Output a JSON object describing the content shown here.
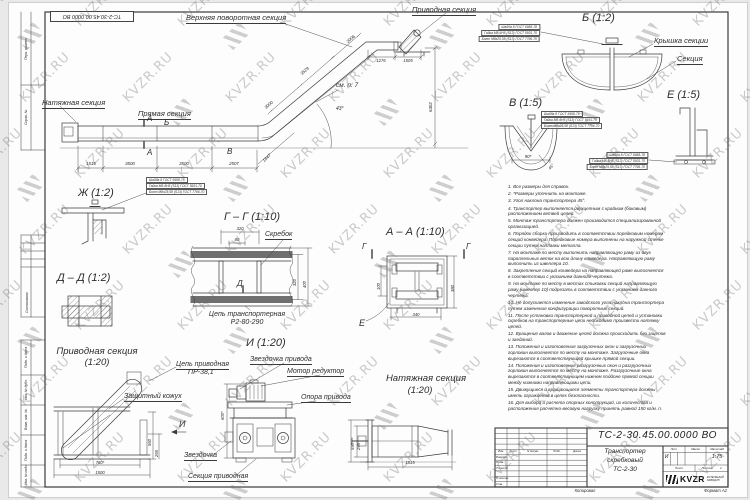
{
  "watermark": {
    "text": "KVZR.RU"
  },
  "stamp": {
    "text": "ТС-2-30.45.00.0000 ВО"
  },
  "labels": [
    {
      "n": "label-natyazhnaya-s",
      "t": "Натяжная секция",
      "x": 42,
      "y": 99,
      "fs": 7.5,
      "u": 1
    },
    {
      "n": "label-pryamaya-s",
      "t": "Прямая секция",
      "x": 138,
      "y": 110,
      "fs": 7.5,
      "u": 1
    },
    {
      "n": "label-verhnyaya-povorotnaya-s",
      "t": "Верхняя поворотная секция",
      "x": 186,
      "y": 14,
      "fs": 7.5,
      "u": 1
    },
    {
      "n": "label-privodnaya-s",
      "t": "Приводная секция",
      "x": 412,
      "y": 6,
      "fs": 7.5,
      "u": 1
    },
    {
      "n": "section-mark-a-top",
      "t": "А",
      "x": 147,
      "y": 115,
      "fs": 8
    },
    {
      "n": "section-mark-a-bottom",
      "t": "А",
      "x": 147,
      "y": 149,
      "fs": 8
    },
    {
      "n": "detail-mark-b",
      "t": "Б",
      "x": 164,
      "y": 119,
      "fs": 8
    },
    {
      "n": "detail-mark-v",
      "t": "В",
      "x": 227,
      "y": 148,
      "fs": 8
    },
    {
      "n": "dim-1515",
      "t": "1515",
      "x": 91,
      "y": 162,
      "fs": 4.4,
      "al": "c"
    },
    {
      "n": "dim-3500-1",
      "t": "3500",
      "x": 130,
      "y": 162,
      "fs": 4.4,
      "al": "c"
    },
    {
      "n": "dim-3500-2",
      "t": "3500",
      "x": 184,
      "y": 162,
      "fs": 4.4,
      "al": "c"
    },
    {
      "n": "dim-2507",
      "t": "2507",
      "x": 234,
      "y": 162,
      "fs": 4.4,
      "al": "c"
    },
    {
      "n": "dim-1847",
      "t": "1847",
      "x": 262,
      "y": 160,
      "fs": 4.4,
      "rot": -42
    },
    {
      "n": "dim-2006",
      "t": "2006",
      "x": 346,
      "y": 41,
      "fs": 4.4,
      "rot": -41
    },
    {
      "n": "dim-3529",
      "t": "3529",
      "x": 300,
      "y": 73,
      "fs": 4.4,
      "rot": -41
    },
    {
      "n": "dim-3000",
      "t": "3000",
      "x": 264,
      "y": 107,
      "fs": 4.4,
      "rot": -41
    },
    {
      "n": "note-see-item-7",
      "t": "см. п. 7",
      "x": 336,
      "y": 83,
      "fs": 6.5
    },
    {
      "n": "dim-angle-43",
      "t": "43°",
      "x": 336,
      "y": 107,
      "fs": 5
    },
    {
      "n": "dim-1276",
      "t": "1276",
      "x": 381,
      "y": 59,
      "fs": 4.2,
      "al": "c"
    },
    {
      "n": "dim-1505",
      "t": "1505",
      "x": 408,
      "y": 59,
      "fs": 4.2,
      "al": "c"
    },
    {
      "n": "dim-6302",
      "t": "6302",
      "x": 429,
      "y": 112,
      "fs": 4.4,
      "rot": -90
    },
    {
      "n": "callout-washer",
      "t": "Шайба 8 ГОСТ 6958-78",
      "x": 540,
      "y": 24,
      "fs": 3.3,
      "al": "r",
      "cls": "box"
    },
    {
      "n": "callout-nut",
      "t": "Гайка М8-6Н5 (S13) ГОСТ 5931-70",
      "x": 540,
      "y": 30,
      "fs": 3.3,
      "al": "r",
      "cls": "box"
    },
    {
      "n": "callout-bolt",
      "t": "Болт М8х25,58 (S13) ГОСТ 7796-70",
      "x": 540,
      "y": 36,
      "fs": 3.3,
      "al": "r",
      "cls": "box"
    },
    {
      "n": "detail-b-title",
      "t": "Б (1:2)",
      "x": 582,
      "y": 13,
      "fs": 11
    },
    {
      "n": "label-kryshka-sekcii",
      "t": "Крышка секции",
      "x": 654,
      "y": 37,
      "fs": 7.5,
      "u": 1
    },
    {
      "n": "label-sekciya",
      "t": "Секция",
      "x": 677,
      "y": 55,
      "fs": 7.5,
      "u": 1
    },
    {
      "n": "detail-v-title",
      "t": "В (1:5)",
      "x": 509,
      "y": 98,
      "fs": 11
    },
    {
      "n": "callout-washer-v",
      "t": "Шайба 8 ГОСТ 6958-78",
      "x": 541,
      "y": 111,
      "fs": 3.3,
      "cls": "box"
    },
    {
      "n": "callout-nut-v",
      "t": "Гайка М8-6Н5 (S13) ГОСТ 5931-70",
      "x": 541,
      "y": 117,
      "fs": 3.3,
      "cls": "box"
    },
    {
      "n": "callout-bolt-v",
      "t": "Болт М8х25,58 (S13) ГОСТ 7796-70",
      "x": 541,
      "y": 123,
      "fs": 3.3,
      "cls": "box"
    },
    {
      "n": "dim-90",
      "t": "90*",
      "x": 528,
      "y": 155,
      "fs": 4.4,
      "al": "c"
    },
    {
      "n": "dim-angle-45",
      "t": "45°",
      "x": 548,
      "y": 168,
      "fs": 4,
      "rot": -50
    },
    {
      "n": "detail-e-title",
      "t": "Е (1:5)",
      "x": 667,
      "y": 90,
      "fs": 11
    },
    {
      "n": "callout-washer-e",
      "t": "Шайба 8 ГОСТ 6958-78",
      "x": 648,
      "y": 152,
      "fs": 3.3,
      "al": "r",
      "cls": "box"
    },
    {
      "n": "callout-nut-e",
      "t": "Гайка М8-6Н5 (S13) ГОСТ 5931-70",
      "x": 648,
      "y": 158,
      "fs": 3.3,
      "al": "r",
      "cls": "box"
    },
    {
      "n": "callout-bolt-e",
      "t": "Болт М8х25,58 (S13) ГОСТ 7796-70",
      "x": 648,
      "y": 164,
      "fs": 3.3,
      "al": "r",
      "cls": "box"
    },
    {
      "n": "detail-zh-title",
      "t": "Ж (1:2)",
      "x": 78,
      "y": 188,
      "fs": 11
    },
    {
      "n": "callout-washer-zh",
      "t": "Шайба 8 ГОСТ 6958-78",
      "x": 146,
      "y": 177,
      "fs": 3.3,
      "cls": "box"
    },
    {
      "n": "callout-nut-zh",
      "t": "Гайка М8-6Н5 (S13) ГОСТ 5931-70",
      "x": 146,
      "y": 183,
      "fs": 3.3,
      "cls": "box"
    },
    {
      "n": "callout-bolt-zh",
      "t": "Болт М8х25,58 (S13) ГОСТ 7796-70",
      "x": 146,
      "y": 189,
      "fs": 3.3,
      "cls": "box"
    },
    {
      "n": "detail-dd-title",
      "t": "Д – Д (1:2)",
      "x": 57,
      "y": 273,
      "fs": 11
    },
    {
      "n": "detail-gg-title",
      "t": "Г – Г (1:10)",
      "x": 224,
      "y": 212,
      "fs": 11
    },
    {
      "n": "dim-320-top",
      "t": "320",
      "x": 240,
      "y": 227,
      "fs": 4.2,
      "al": "c"
    },
    {
      "n": "dim-80",
      "t": "80",
      "x": 237,
      "y": 238,
      "fs": 4.2,
      "al": "c"
    },
    {
      "n": "label-skrebok",
      "t": "Скребок",
      "x": 265,
      "y": 231,
      "fs": 7,
      "u": 1
    },
    {
      "n": "section-mark-d",
      "t": "Д",
      "x": 237,
      "y": 280,
      "fs": 8
    },
    {
      "n": "dim-320-right",
      "t": "320",
      "x": 293,
      "y": 286,
      "fs": 4.2,
      "rot": -90
    },
    {
      "n": "dim-400",
      "t": "400",
      "x": 303,
      "y": 288,
      "fs": 4.2,
      "rot": -90
    },
    {
      "n": "label-cep-transporternaya",
      "t": "Цепь транспортерная",
      "x": 247,
      "y": 311,
      "fs": 7,
      "al": "c"
    },
    {
      "n": "label-cep-type",
      "t": "Р2-80-290",
      "x": 247,
      "y": 319,
      "fs": 7,
      "al": "c"
    },
    {
      "n": "detail-aa-title",
      "t": "А – А (1:10)",
      "x": 386,
      "y": 227,
      "fs": 11
    },
    {
      "n": "section-mark-g-left",
      "t": "Г",
      "x": 362,
      "y": 243,
      "fs": 8
    },
    {
      "n": "section-mark-g-right",
      "t": "Г",
      "x": 466,
      "y": 243,
      "fs": 8
    },
    {
      "n": "dim-100",
      "t": "100",
      "x": 377,
      "y": 290,
      "fs": 4.2,
      "rot": -90
    },
    {
      "n": "dim-380",
      "t": "380",
      "x": 451,
      "y": 292,
      "fs": 4.2,
      "rot": -90
    },
    {
      "n": "dim-340",
      "t": "340",
      "x": 416,
      "y": 313,
      "fs": 4.2,
      "al": "c"
    },
    {
      "n": "detail-mark-e",
      "t": "Е",
      "x": 359,
      "y": 319,
      "fs": 9
    },
    {
      "n": "privod-view-title-1",
      "t": "Приводная секция",
      "x": 97,
      "y": 347,
      "fs": 9.5,
      "al": "c"
    },
    {
      "n": "privod-view-title-2",
      "t": "(1:20)",
      "x": 97,
      "y": 358,
      "fs": 9.5,
      "al": "c"
    },
    {
      "n": "label-zashitny-kozhuh",
      "t": "Защитный кожух",
      "x": 124,
      "y": 393,
      "fs": 7,
      "u": 1
    },
    {
      "n": "label-cep-privodnaya",
      "t": "Цепь приводная",
      "x": 176,
      "y": 361,
      "fs": 7,
      "u": 1
    },
    {
      "n": "label-cep-privodnaya-type",
      "t": "ПР-38,1",
      "x": 188,
      "y": 369,
      "fs": 7
    },
    {
      "n": "dim-780",
      "t": "780*",
      "x": 100,
      "y": 461,
      "fs": 4.2,
      "al": "c"
    },
    {
      "n": "dim-1500",
      "t": "1500",
      "x": 100,
      "y": 471,
      "fs": 4.2,
      "al": "c"
    },
    {
      "n": "dim-560",
      "t": "560",
      "x": 148,
      "y": 446,
      "fs": 4.2,
      "rot": -90
    },
    {
      "n": "dim-265",
      "t": "265",
      "x": 155,
      "y": 457,
      "fs": 4.2,
      "rot": -90
    },
    {
      "n": "view-mark-i",
      "t": "И",
      "x": 179,
      "y": 420,
      "fs": 9
    },
    {
      "n": "view-i-title",
      "t": "И (1:20)",
      "x": 246,
      "y": 338,
      "fs": 11
    },
    {
      "n": "label-zvezdochka-privoda",
      "t": "Звездочка привода",
      "x": 250,
      "y": 356,
      "fs": 7,
      "u": 1
    },
    {
      "n": "label-motor-reduktor",
      "t": "Мотор редуктор",
      "x": 287,
      "y": 368,
      "fs": 7,
      "u": 1
    },
    {
      "n": "label-opora-privoda",
      "t": "Опора привода",
      "x": 301,
      "y": 394,
      "fs": 7,
      "u": 1
    },
    {
      "n": "label-zvezdochka",
      "t": "Звездочка",
      "x": 184,
      "y": 452,
      "fs": 7,
      "u": 1
    },
    {
      "n": "label-sekciya-privodnaya",
      "t": "Секция приводная",
      "x": 188,
      "y": 473,
      "fs": 7,
      "u": 1
    },
    {
      "n": "dim-600",
      "t": "600*",
      "x": 221,
      "y": 420,
      "fs": 4.2,
      "rot": -90
    },
    {
      "n": "natyazh-view-title-1",
      "t": "Натяжная секция",
      "x": 426,
      "y": 374,
      "fs": 9.5,
      "al": "c"
    },
    {
      "n": "natyazh-view-title-2",
      "t": "(1:20)",
      "x": 420,
      "y": 386,
      "fs": 9.5,
      "al": "c"
    },
    {
      "n": "dim-1515-natyazh",
      "t": "1515",
      "x": 410,
      "y": 461,
      "fs": 4.2,
      "al": "c"
    },
    {
      "n": "dim-295",
      "t": "295",
      "x": 357,
      "y": 450,
      "fs": 4.2,
      "rot": -90
    },
    {
      "n": "dim-590",
      "t": "590",
      "x": 351,
      "y": 450,
      "fs": 4.2,
      "rot": -90
    },
    {
      "n": "frame-label-perv-primen",
      "t": "Перв. примен.",
      "x": 25,
      "y": 60,
      "fs": 3.4,
      "rot": -90
    },
    {
      "n": "frame-label-sprav-no",
      "t": "Справ. №",
      "x": 25,
      "y": 125,
      "fs": 3.4,
      "rot": -90
    },
    {
      "n": "frame-label-soglasovano",
      "t": "Согласовано",
      "x": 26,
      "y": 313,
      "fs": 3.4,
      "rot": -90
    },
    {
      "n": "frame-label-podp-data-1",
      "t": "Подп. и дата",
      "x": 25,
      "y": 368,
      "fs": 3.4,
      "rot": -90
    },
    {
      "n": "frame-label-inv-dubl",
      "t": "Инв. № дубл.",
      "x": 25,
      "y": 400,
      "fs": 3.4,
      "rot": -90
    },
    {
      "n": "frame-label-vzam-inv",
      "t": "Взам. инв. №",
      "x": 25,
      "y": 430,
      "fs": 3.4,
      "rot": -90
    },
    {
      "n": "frame-label-podp-data-2",
      "t": "Подп. и дата",
      "x": 25,
      "y": 461,
      "fs": 3.4,
      "rot": -90
    },
    {
      "n": "frame-label-inv-podl",
      "t": "Инв. № подл.",
      "x": 25,
      "y": 485,
      "fs": 3.4,
      "rot": -90
    },
    {
      "n": "copied-label",
      "t": "Копировал",
      "x": 585,
      "y": 489,
      "fs": 4.2,
      "al": "c"
    },
    {
      "n": "format-label",
      "t": "Формат А2",
      "x": 727,
      "y": 489,
      "fs": 4.2,
      "al": "r"
    }
  ],
  "notes": {
    "items": [
      "1. Все размеры для справок.",
      "2. *Размеры уточнить на монтаже.",
      "3. Угол наклона транспортера 45°.",
      "4. Транспортер выполняется двухцепным с крайним (боковым) расположением ветвей цепей.",
      "5. Монтаж транспортера должен производится специализированной организацией.",
      "6. Порядок сборки производить в соответствии порядковым номерам секций конвейера. Порядковые номера выполнены на наружной стенке секции путем наплавки металла.",
      "7. На монтаже по месту выполнить направляющую раму из двух параллельных веток на всю длину конвейера. Направляющую раму выполнить из швеллера 10.",
      "8. Закрепление секций конвейера на направляющей раме выполняется в соответствии с указанием данного чертежа.",
      "9. На монтаже по месту в местах стыковки секций направляющую раму (швеллер 10) подрезать в соответствии с указанием данного чертежа.",
      "10. Не допускается изменение заводского угла наклона транспортера путем изменения конфигурации поворотных секций.",
      "11. После установки транспортерной и приводной цепей и установки скребков на транспортерные цепи необходимо произвести натяжку цепей.",
      "12. Вращение валов и движение цепей должна происходить без зацепов и заеданий.",
      "13. Положения и изготовления загрузочных окон и загрузочных горловин выполняется по месту на монтаже. Загрузочные окна вырезаются в соответствующей крышке прямой секции.",
      "14. Положения и изготовления разгрузочных окон и разгрузочных горловин выполняется по месту на монтаже. Разгрузочные окна вырезаются в соответствующем нижнем поддоне прямой секции между нижними направляющими цепи.",
      "15. Движущиеся и вращающиеся элементы транспортера должны иметь ограждения в целях безопасности.",
      "16. Для выбора и расчета опорных конструкций, их количества и расположения расчетно-весовую нагрузку принять равной 150 кг/м. п."
    ]
  },
  "title_block": {
    "doc_number": "ТС-2-30.45.00.0000 ВО",
    "product_title_lines": [
      "Транспортер",
      "скребковый",
      "ТС-2-30"
    ],
    "columns": [
      "Изм.",
      "Лист",
      "N докум.",
      "Подп.",
      "Дата"
    ],
    "rows": [
      "Разраб.",
      "Пров.",
      "Т.контр.",
      "Н.контр.",
      "Утв."
    ],
    "lit_header": "Лит.",
    "mass_header": "Масса",
    "scale_header": "Масштаб",
    "lit_value": "И",
    "scale_value": "1:75",
    "sheet_label": "Лист",
    "sheets_label": "Листов",
    "sheets_value": "1",
    "logo_text": "KVZR",
    "logo_sub_lines": [
      "КОТЕЛЬНЫЙ",
      "ЗАВОД.РУ"
    ]
  }
}
